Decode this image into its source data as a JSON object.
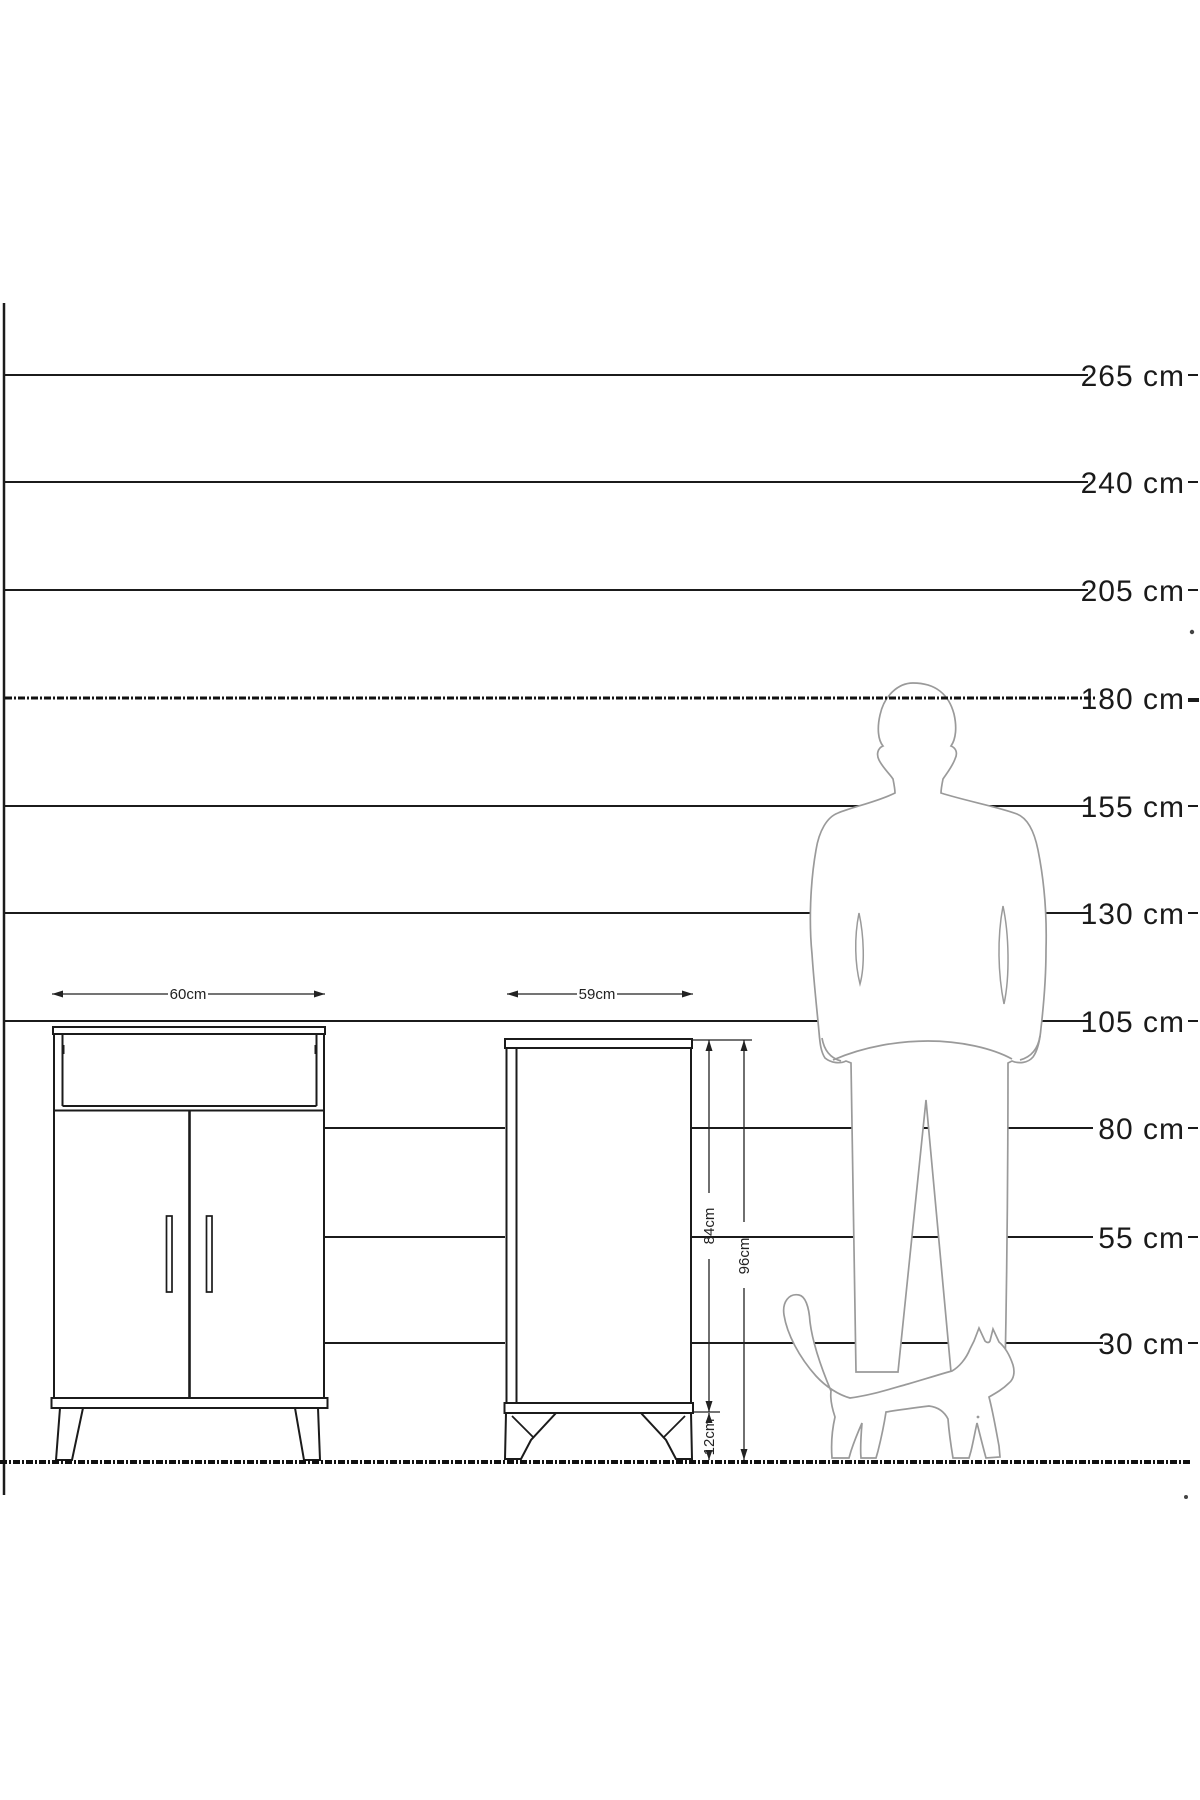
{
  "diagram": {
    "scale": {
      "labels": [
        "265 cm",
        "240 cm",
        "205 cm",
        "180 cm",
        "155 cm",
        "130 cm",
        "105 cm",
        "80 cm",
        "55 cm",
        "30 cm"
      ]
    },
    "dimensions": {
      "cabinet1_width": "60cm",
      "cabinet2_width": "59cm",
      "cabinet2_body_height": "84cm",
      "cabinet2_total_height": "96cm",
      "cabinet2_leg_height": "12cm"
    },
    "icons": {
      "man": "man-silhouette",
      "cat": "cat-silhouette"
    },
    "colors": {
      "line": "#1b1b1b",
      "silhouette_outline": "#9a9a9a",
      "background": "#ffffff"
    }
  }
}
